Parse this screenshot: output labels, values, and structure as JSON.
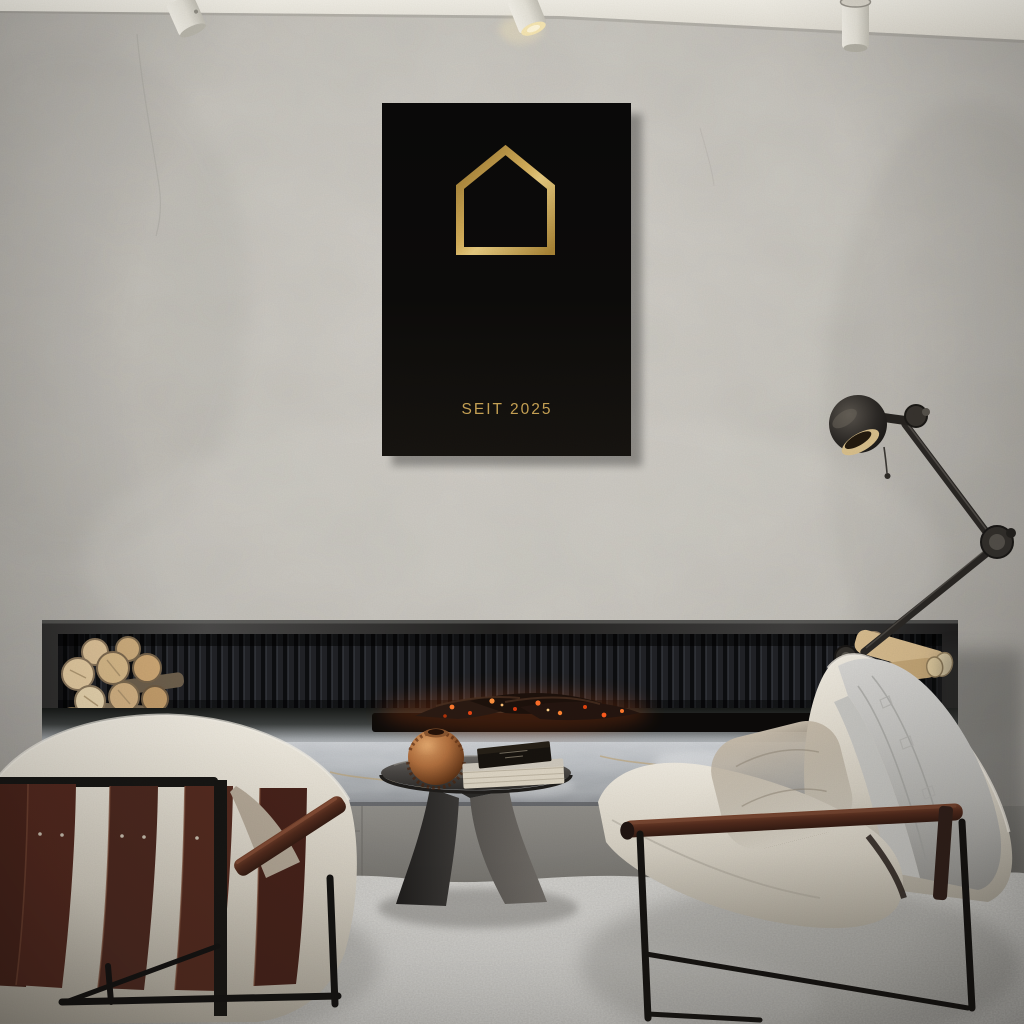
{
  "scene": {
    "setting": "minimalist concrete living room with linear fireplace, two cream sling armchairs, metal side table and articulated floor lamp",
    "colors": {
      "wall": "#c9c6bf",
      "ceiling": "#e8e4da",
      "fireplace_frame": "#2a2a29",
      "slat_panel": "#17181b",
      "marble_bench": "#b9bcc0",
      "fire_accent": "#ff6a22",
      "firewood": "#ddc093",
      "rug": "#c7c6c2",
      "floor": "#8a8883",
      "chair_fabric": "#e7e2d6",
      "leather_straps": "#4e2920",
      "armrest_wood": "#4a2a1d",
      "throw_blanket": "#c6c5c1",
      "pillow": "#b0a494",
      "lamp_metal": "#2b2825",
      "table_metal": "#454341",
      "copper_sphere": "#b06f3e"
    }
  },
  "poster": {
    "tagline": "SEIT 2025",
    "icon": "house-outline-icon",
    "colors": {
      "background": "#0b0a09",
      "gold": "#c8a355"
    }
  }
}
